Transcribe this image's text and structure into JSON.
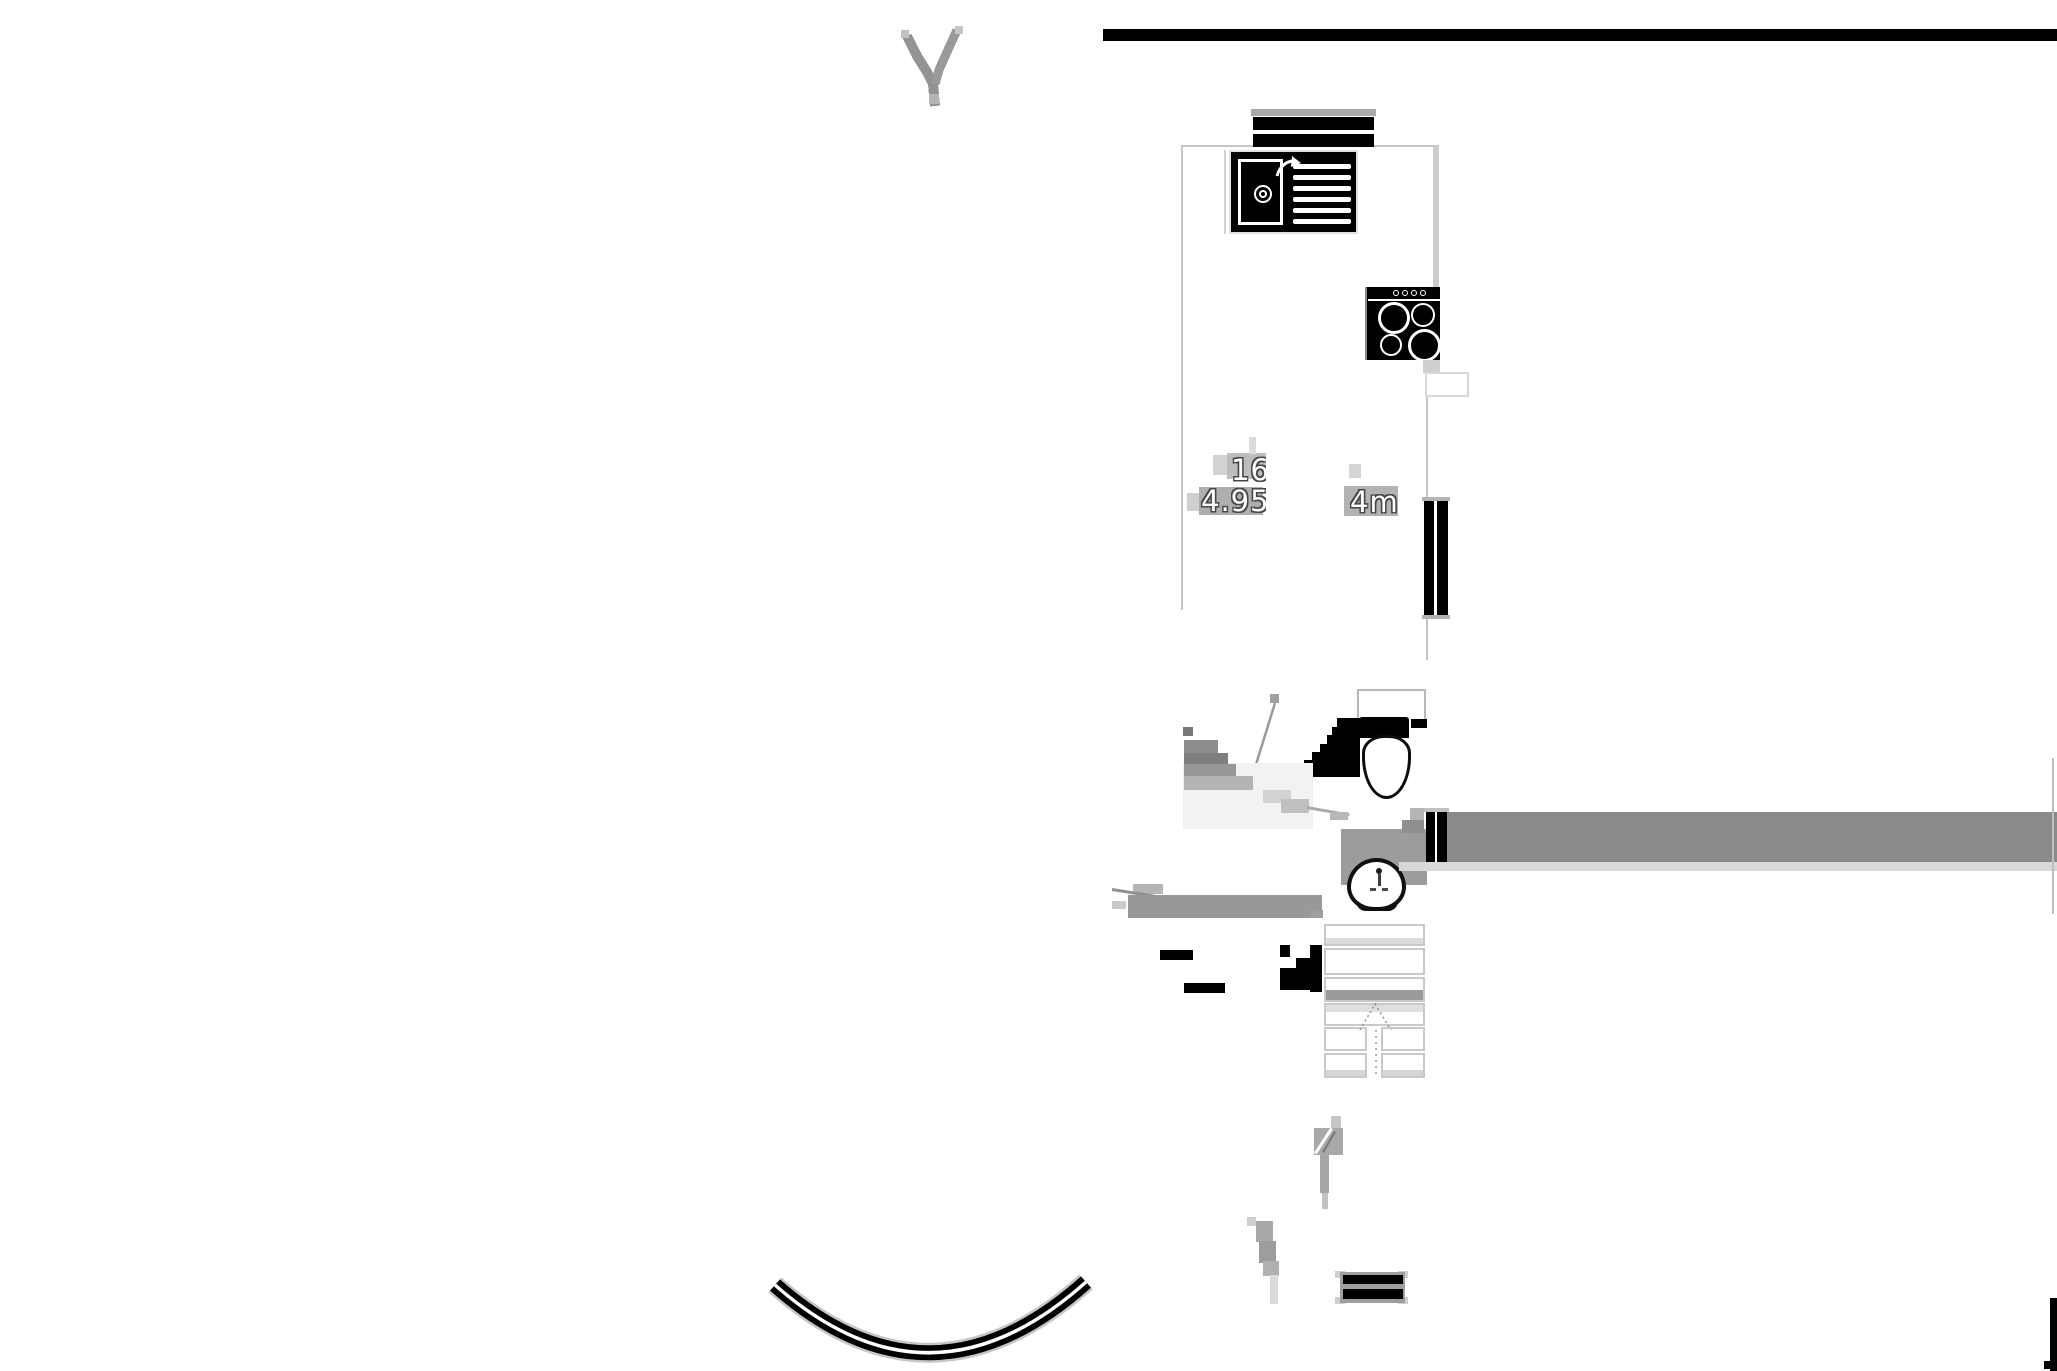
{
  "plan": {
    "labels": {
      "room_number": "16",
      "area": "4.95",
      "dimension": "4m"
    },
    "fixtures": [
      "kitchen-sink",
      "cooktop-4-burners",
      "toilet",
      "wash-basin",
      "staircase-up",
      "window-double-bar",
      "door-jamb",
      "road-curve",
      "tree"
    ],
    "colors": {
      "ink": "#000000",
      "wall_gray": "#8a8a8a",
      "light_gray": "#d8d8d8",
      "artifact_gray": "#a8a8a8",
      "floor_tint": "#efefef",
      "outline_gray": "#c6c6c6"
    }
  }
}
